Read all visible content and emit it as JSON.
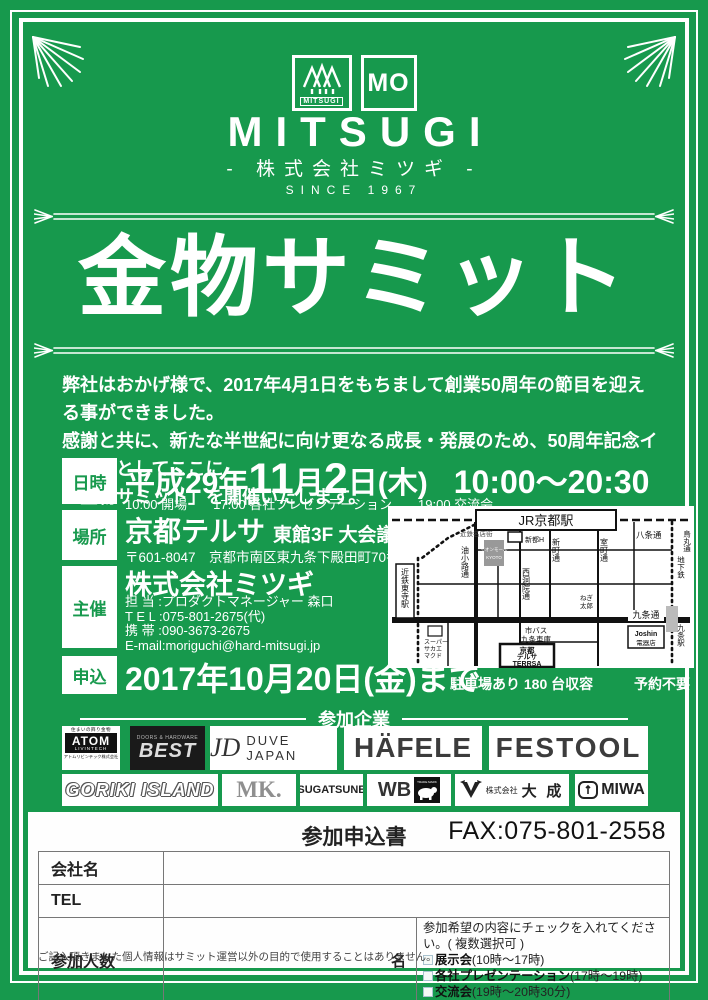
{
  "colors": {
    "green": "#17994d",
    "white": "#ffffff",
    "dark": "#222222"
  },
  "logo": {
    "mark_label": "MITSUGI",
    "mo": "MO",
    "brand": "MITSUGI",
    "subtitle": "- 株式会社ミツギ -",
    "since": "SINCE 1967"
  },
  "title": "金物サミット",
  "intro": "弊社はおかげ様で、2017年4月1日をもちまして創業50周年の節目を迎える事ができました。\n感謝と共に、新たな半世紀に向け更なる成長・発展のため、50周年記念イベントとしてここに\n「金物サミット」を開催いたします。",
  "details": {
    "date": {
      "label": "日時",
      "era": "平成29年",
      "month_num": "11",
      "month_unit": "月",
      "day_num": "2",
      "day_unit": "日(木)",
      "time": "10:00〜20:30",
      "sub": "10:00 開場　　17:00 各社プレゼンテーション　　19:00 交流会"
    },
    "place": {
      "label": "場所",
      "name": "京都テルサ",
      "room": "東館3F 大会議室",
      "address": "〒601-8047　京都市南区東九条下殿田町70番地"
    },
    "organizer": {
      "label": "主催",
      "company": "株式会社ミツギ",
      "contacts": "担 当 :プロダクトマネージャー 森口\nT E L :075-801-2675(代)\n携 帯 :090-3673-2675\nE-mail:moriguchi@hard-mitsugi.jp"
    },
    "apply": {
      "label": "申込",
      "deadline": "2017年10月20日(金)まで"
    }
  },
  "map": {
    "jr_station": "JR京都駅",
    "meitengai": "近鉄名店街",
    "hachijo": "八条通",
    "karasuma": "烏丸通",
    "aburakoji": "油小路通",
    "nishinotoin": "西洞院通",
    "shinmachi": "新町通",
    "muromachi": "室町通",
    "toji_station": "近鉄東寺駅",
    "kujo_street": "九条通",
    "subway": "地下鉄",
    "kujo_station": "九条駅",
    "joshin": "Joshin",
    "joshin_sub": "電器店",
    "bus1": "市バス",
    "bus2": "九条車庫",
    "terrsa1": "京都",
    "terrsa2": "テルサ",
    "terrsa3": "TERRSA",
    "super1": "スーパー",
    "super2": "サカエ",
    "super3": "マクド",
    "aeon1": "イオンモール",
    "aeon2": "KYOTO",
    "shinto": "新都H",
    "negi1": "ねぎ",
    "negi2": "太郎",
    "caption_parking": "駐車場あり 180 台収容",
    "caption_reserve": "予約不要"
  },
  "companies": {
    "header": "参加企業",
    "atom": {
      "tagline": "住まいの飾り金物",
      "name": "ATOM",
      "sub": "LIVINTECH",
      "company": "アトムリビンテック株式会社"
    },
    "best": {
      "tagline": "DOORS & HARDWARE",
      "name": "BEST"
    },
    "duve": {
      "mono": "JD",
      "name": "DUVE JAPAN"
    },
    "hafele": {
      "name": "HÄFELE"
    },
    "festool": {
      "name": "FESTOOL"
    },
    "goriki": {
      "name": "GORIKI ISLAND"
    },
    "mk": {
      "name": "MK."
    },
    "sugatsune": {
      "name": "SUGATSUNE"
    },
    "wb": {
      "name": "WB",
      "mark": "TRADE MARK"
    },
    "taisei": {
      "prefix": "株式会社",
      "name": "大 成"
    },
    "miwa": {
      "name": "MIWA"
    }
  },
  "form": {
    "title": "参加申込書",
    "fax": "FAX:075-801-2558",
    "rows": {
      "company": "会社名",
      "tel": "TEL",
      "people": "参加人数",
      "unit": "名"
    },
    "check_instruction": "参加希望の内容にチェックを入れてください。( 複数選択可 )",
    "options": [
      {
        "bold": "展示会",
        "time": "(10時〜17時)"
      },
      {
        "bold": "各社プレゼンテーション",
        "time": "(17時〜19時)"
      },
      {
        "bold": "交流会",
        "time": "(19時〜20時30分)"
      }
    ],
    "note": "ご記入頂きました個人情報はサミット運営以外の目的で使用することはありません。"
  }
}
